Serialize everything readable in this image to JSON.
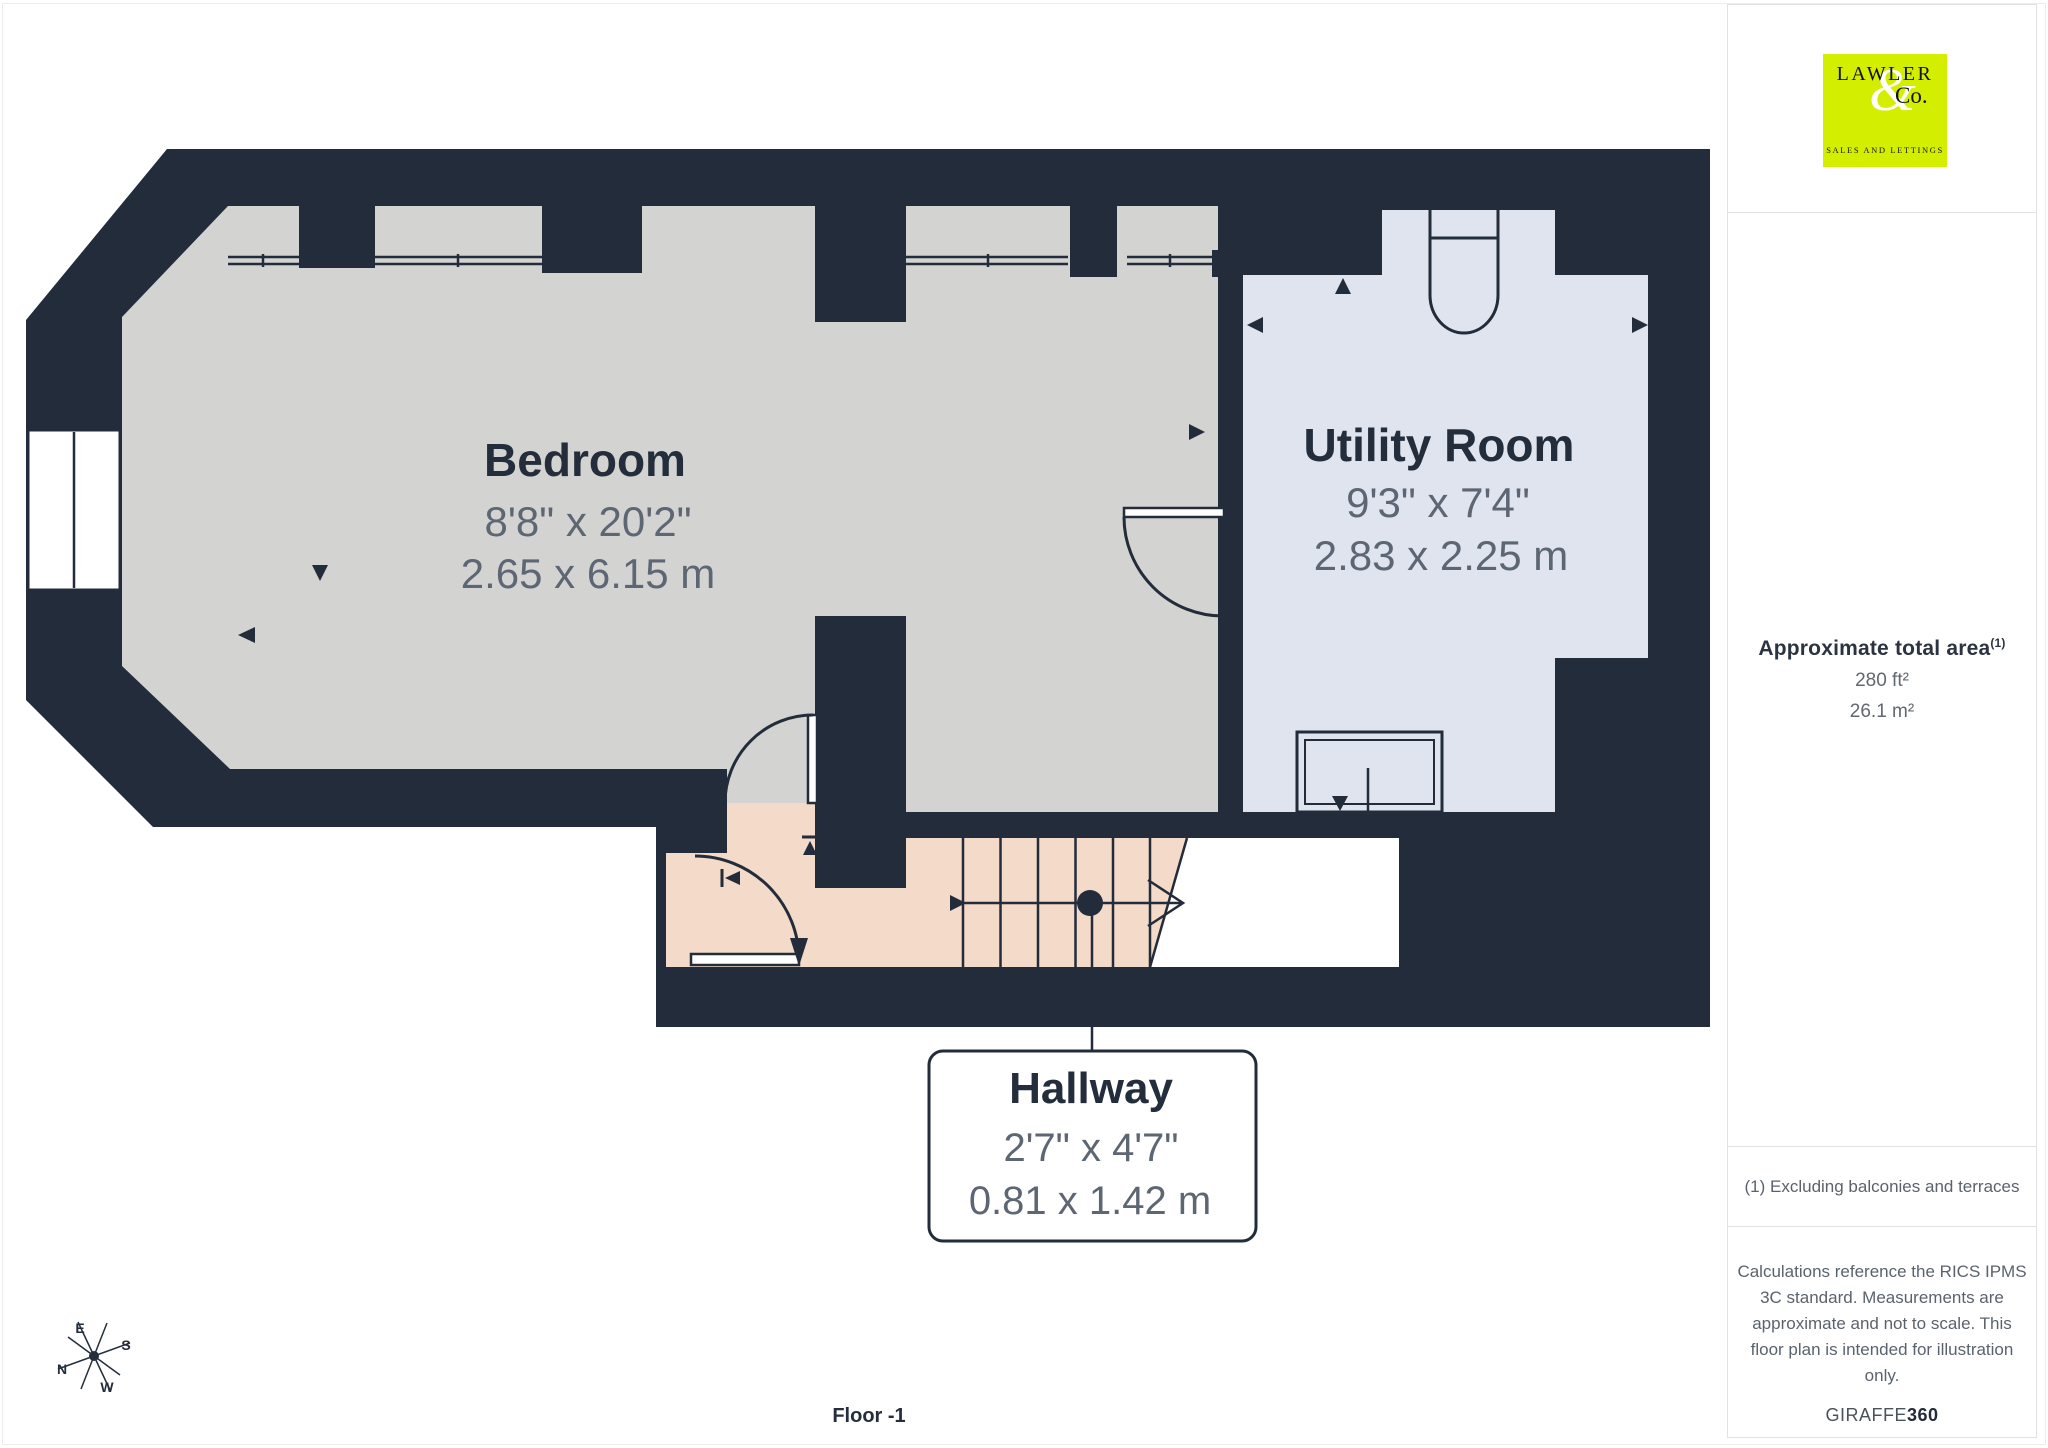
{
  "plan": {
    "floor_label": "Floor -1",
    "rooms": [
      {
        "name": "Bedroom",
        "imperial": "8'8\" x 20'2\"",
        "metric": "2.65 x 6.15 m"
      },
      {
        "name": "Utility Room",
        "imperial": "9'3\" x 7'4\"",
        "metric": "2.83 x 2.25 m"
      },
      {
        "name": "Hallway",
        "imperial": "2'7\" x 4'7\"",
        "metric": "0.81 x 1.42 m"
      }
    ],
    "compass": {
      "n": "N",
      "e": "E",
      "s": "S",
      "w": "W"
    }
  },
  "sidebar": {
    "logo": {
      "line1": "LAWLER",
      "amp": "&",
      "line2": "Co.",
      "tagline": "SALES AND LETTINGS"
    },
    "area": {
      "title": "Approximate total area",
      "sup": "(1)",
      "imperial": "280 ft²",
      "metric": "26.1 m²"
    },
    "footnote": "(1) Excluding balconies and terraces",
    "disclaimer": [
      "Calculations reference the RICS IPMS",
      "3C standard. Measurements are",
      "approximate and not to scale. This",
      "floor plan is intended for illustration",
      "only."
    ],
    "brand": {
      "normal": "GIRAFFE",
      "bold": "360"
    }
  },
  "colors": {
    "wall": "#222c3a",
    "bedroom_floor": "#d3d3d2",
    "utility_floor": "#dfe4ef",
    "hallway_floor": "#f4dac8",
    "void": "#ffffff",
    "logo_bg": "#d4ee00",
    "dim_text": "#5d6673",
    "title_text": "#232d3b"
  }
}
